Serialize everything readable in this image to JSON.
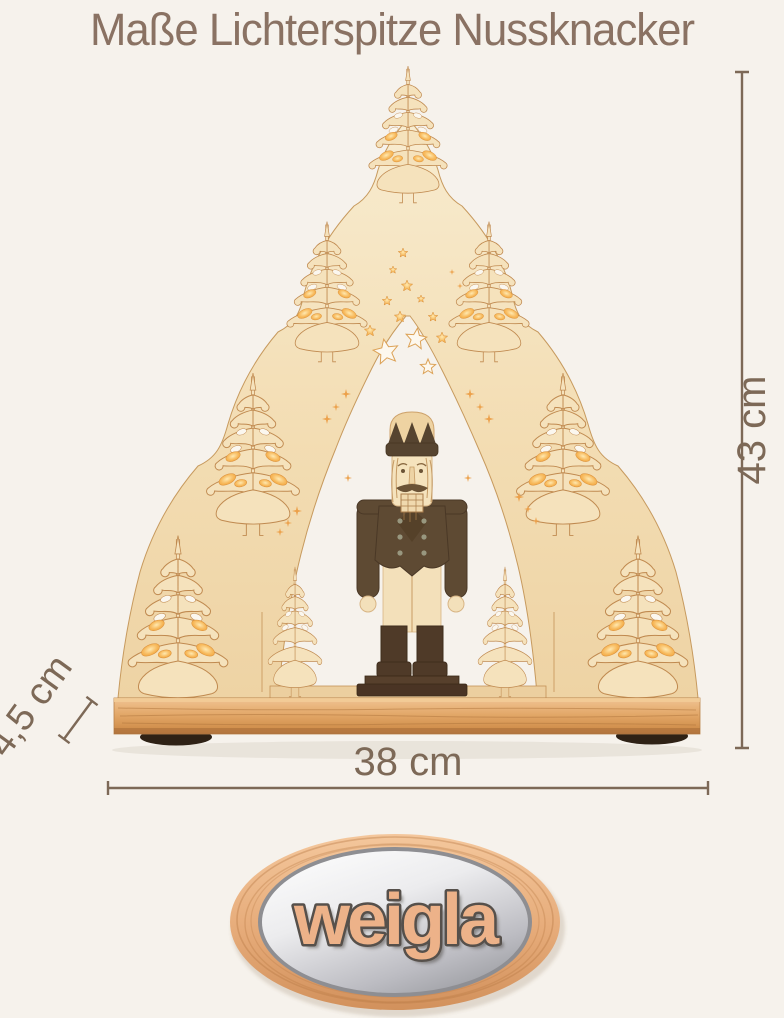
{
  "page": {
    "background_color": "#f6f2ec"
  },
  "title": {
    "text": "Maße Lichterspitze Nussknacker",
    "color": "#8a7263"
  },
  "annotations": {
    "color": "#7d6957",
    "height": {
      "value": "43 cm",
      "orientation": "vertical-right"
    },
    "width": {
      "value": "38 cm",
      "orientation": "horizontal-bottom"
    },
    "depth": {
      "value": "4,5 cm",
      "orientation": "diagonal-left"
    }
  },
  "product": {
    "colors": {
      "wood_light": "#f5e2bc",
      "wood_outline": "#c08a50",
      "wood_base": "#e3a869",
      "glow": "#f2a644",
      "dark_wood": "#5e4a33",
      "cream": "#f3e0ba"
    }
  },
  "logo": {
    "text": "weigla",
    "text_color": "#edb289",
    "outline_color": "#56504b",
    "badge_wood": "#e9b286",
    "badge_silver": "#e8e8ea"
  }
}
